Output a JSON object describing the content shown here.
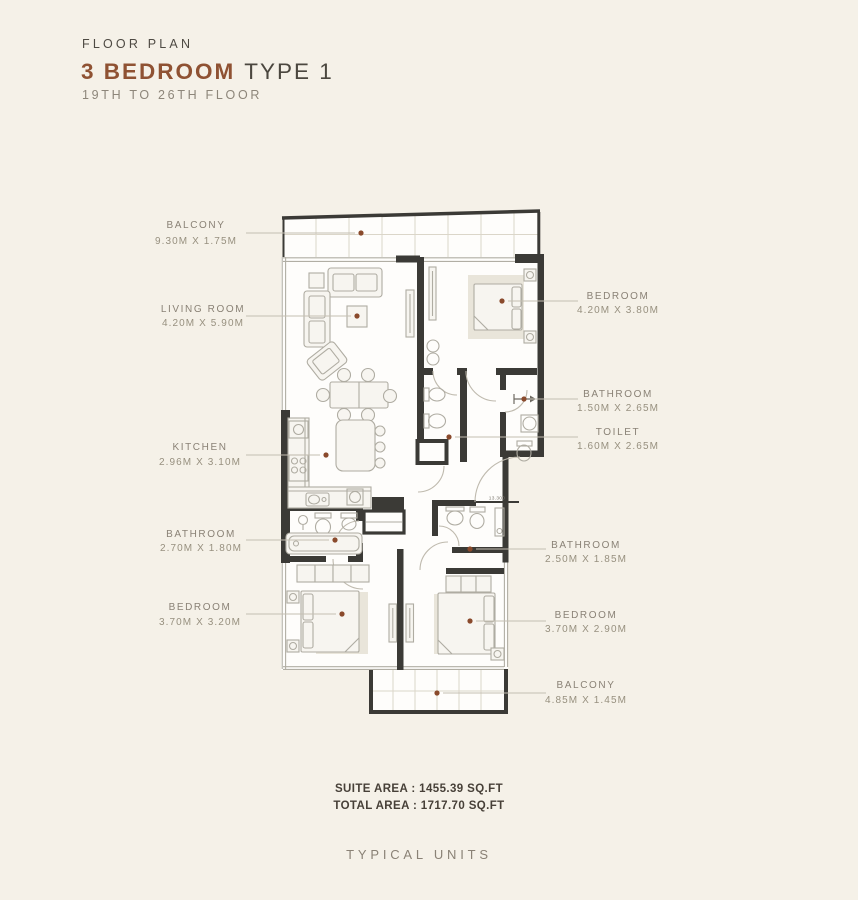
{
  "header": {
    "kicker": "FLOOR PLAN",
    "title_accent": "3 BEDROOM",
    "title_rest": "TYPE 1",
    "subtitle": "19TH TO 26TH FLOOR"
  },
  "labels": {
    "left": [
      {
        "name": "BALCONY",
        "dims": "9.30M X 1.75M"
      },
      {
        "name": "LIVING ROOM",
        "dims": "4.20M X 5.90M"
      },
      {
        "name": "KITCHEN",
        "dims": "2.96M X 3.10M"
      },
      {
        "name": "BATHROOM",
        "dims": "2.70M X 1.80M"
      },
      {
        "name": "BEDROOM",
        "dims": "3.70M X 3.20M"
      }
    ],
    "right": [
      {
        "name": "BEDROOM",
        "dims": "4.20M X 3.80M"
      },
      {
        "name": "BATHROOM",
        "dims": "1.50M X 2.65M"
      },
      {
        "name": "TOILET",
        "dims": "1.60M X 2.65M"
      },
      {
        "name": "BATHROOM",
        "dims": "2.50M X 1.85M"
      },
      {
        "name": "BEDROOM",
        "dims": "3.70M X 2.90M"
      },
      {
        "name": "BALCONY",
        "dims": "4.85M X 1.45M"
      }
    ]
  },
  "plan": {
    "level_marker": "13.300"
  },
  "summary": {
    "suite_area": "SUITE AREA : 1455.39 SQ.FT",
    "total_area": "TOTAL AREA : 1717.70 SQ.FT"
  },
  "footer": {
    "caption": "TYPICAL UNITS"
  },
  "colors": {
    "background": "#F5F1E8",
    "accent": "#8F5233",
    "wall": "#3B3A36",
    "label": "#8A8276",
    "dot": "#8A4A2C"
  }
}
